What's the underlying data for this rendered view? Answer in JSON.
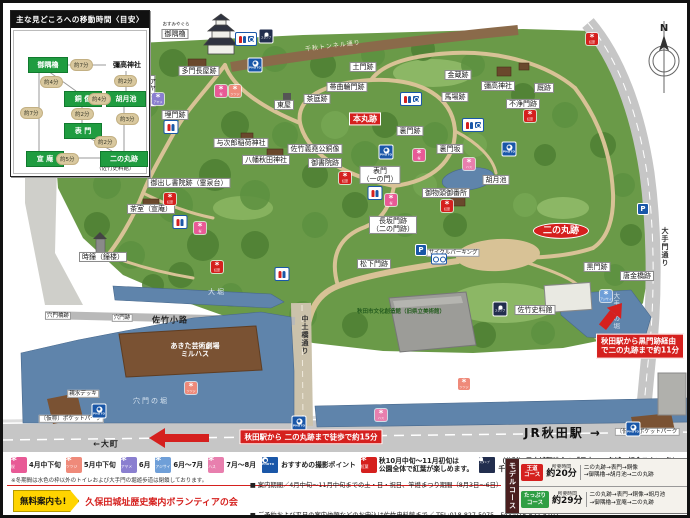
{
  "travel_time_box": {
    "title": "主な見どころへの移動時間〈目安〉",
    "nodes": [
      {
        "id": "osumiyagura",
        "label": "御隅櫓",
        "type": "green",
        "x": 14,
        "y": 26,
        "w": 38,
        "h": 14
      },
      {
        "id": "iyataka-jinja",
        "label": "彌高神社",
        "type": "text",
        "x": 92,
        "y": 28,
        "w": 42,
        "h": 12
      },
      {
        "id": "douzou",
        "label": "銅 像",
        "type": "green",
        "x": 50,
        "y": 60,
        "w": 36,
        "h": 14
      },
      {
        "id": "kogetsu-ike",
        "label": "胡月池",
        "type": "green",
        "x": 92,
        "y": 60,
        "w": 38,
        "h": 14
      },
      {
        "id": "omotemon",
        "label": "表 門",
        "type": "green",
        "x": 50,
        "y": 92,
        "w": 36,
        "h": 14
      },
      {
        "id": "sen-an",
        "label": "宣 庵",
        "type": "green",
        "x": 12,
        "y": 120,
        "w": 36,
        "h": 14
      },
      {
        "id": "ninomaru-ato",
        "label": "二の丸跡",
        "type": "green",
        "x": 86,
        "y": 120,
        "w": 46,
        "h": 14
      }
    ],
    "times": [
      {
        "label": "約7分",
        "x": 56,
        "y": 28
      },
      {
        "label": "約4分",
        "x": 26,
        "y": 45
      },
      {
        "label": "約2分",
        "x": 100,
        "y": 44
      },
      {
        "label": "約4分",
        "x": 74,
        "y": 62
      },
      {
        "label": "約2分",
        "x": 57,
        "y": 77
      },
      {
        "label": "約3分",
        "x": 102,
        "y": 82
      },
      {
        "label": "約7分",
        "x": 6,
        "y": 76
      },
      {
        "label": "約2分",
        "x": 80,
        "y": 105
      },
      {
        "label": "約5分",
        "x": 42,
        "y": 122
      }
    ],
    "note": "（佐竹史料館）"
  },
  "compass": {
    "label": "N"
  },
  "flower_defs": {
    "sakura": {
      "color": "#e85a96",
      "caption": "桜"
    },
    "tsutsuji": {
      "color": "#ef8a7a",
      "caption": "ツツジ"
    },
    "ayame": {
      "color": "#8a7fd0",
      "caption": "アヤメ"
    },
    "ajisai": {
      "color": "#6f9fd8",
      "caption": "アジサイ"
    },
    "hasu": {
      "color": "#e87fae",
      "caption": "ハス"
    },
    "momiji": {
      "color": "#d5201e",
      "caption": "紅葉"
    }
  },
  "map": {
    "labels": [
      {
        "text": "おすみやぐら",
        "x": 173,
        "y": 22,
        "type": "furi"
      },
      {
        "text": "御隅櫓",
        "x": 172,
        "y": 31,
        "type": "place"
      },
      {
        "text": "多門長屋跡",
        "x": 196,
        "y": 68,
        "type": "place"
      },
      {
        "text": "アヤメ園",
        "x": 148,
        "y": 88,
        "type": "place-v"
      },
      {
        "text": "埋門跡",
        "x": 172,
        "y": 112,
        "type": "place"
      },
      {
        "text": "土門跡",
        "x": 360,
        "y": 64,
        "type": "place"
      },
      {
        "text": "帯曲輪門跡",
        "x": 344,
        "y": 84,
        "type": "place"
      },
      {
        "text": "金蔵跡",
        "x": 455,
        "y": 72,
        "type": "place"
      },
      {
        "text": "彌高神社",
        "x": 495,
        "y": 83,
        "type": "place"
      },
      {
        "text": "馬場跡",
        "x": 452,
        "y": 94,
        "type": "place"
      },
      {
        "text": "厩跡",
        "x": 541,
        "y": 85,
        "type": "place"
      },
      {
        "text": "不浄門跡",
        "x": 520,
        "y": 101,
        "type": "place"
      },
      {
        "text": "東屋",
        "x": 281,
        "y": 102,
        "type": "place"
      },
      {
        "text": "茶庭跡",
        "x": 314,
        "y": 96,
        "type": "place"
      },
      {
        "text": "本丸跡",
        "x": 362,
        "y": 116,
        "type": "red"
      },
      {
        "text": "佐竹義堯公銅像",
        "x": 312,
        "y": 146,
        "type": "place"
      },
      {
        "text": "御書院跡",
        "x": 322,
        "y": 160,
        "type": "place"
      },
      {
        "text": "表門\n（一の門）",
        "x": 377,
        "y": 172,
        "type": "place"
      },
      {
        "text": "裏門跡",
        "x": 407,
        "y": 128,
        "type": "place"
      },
      {
        "text": "裏門坂",
        "x": 447,
        "y": 146,
        "type": "place"
      },
      {
        "text": "胡月池",
        "x": 493,
        "y": 177,
        "type": "place"
      },
      {
        "text": "御物頭御番所",
        "x": 443,
        "y": 190,
        "type": "place"
      },
      {
        "text": "御出し書院跡（霊泉台）",
        "x": 186,
        "y": 180,
        "type": "place"
      },
      {
        "text": "八幡秋田神社",
        "x": 263,
        "y": 157,
        "type": "place"
      },
      {
        "text": "与次郎稲荷神社",
        "x": 238,
        "y": 140,
        "type": "place"
      },
      {
        "text": "茶室（宣庵）",
        "x": 148,
        "y": 206,
        "type": "place"
      },
      {
        "text": "時鐘（鐘楼）",
        "x": 100,
        "y": 254,
        "type": "place"
      },
      {
        "text": "長坂門跡\n（二の門跡）",
        "x": 390,
        "y": 222,
        "type": "place"
      },
      {
        "text": "松下門跡",
        "x": 371,
        "y": 261,
        "type": "place"
      },
      {
        "text": "サイクルパーキング",
        "x": 450,
        "y": 250,
        "type": "place-s"
      },
      {
        "text": "二の丸跡",
        "x": 558,
        "y": 228,
        "type": "red-oval"
      },
      {
        "text": "黒門跡",
        "x": 594,
        "y": 264,
        "type": "place"
      },
      {
        "text": "唐金橋跡",
        "x": 634,
        "y": 273,
        "type": "place"
      },
      {
        "text": "佐竹史料館",
        "x": 532,
        "y": 307,
        "type": "place"
      },
      {
        "text": "大手門の堀",
        "x": 612,
        "y": 308,
        "type": "water-v"
      },
      {
        "text": "穴門の堀",
        "x": 148,
        "y": 398,
        "type": "water"
      },
      {
        "text": "大堀",
        "x": 214,
        "y": 289,
        "type": "water"
      },
      {
        "text": "穴門橋跡",
        "x": 55,
        "y": 313,
        "type": "place-s"
      },
      {
        "text": "穴門跡",
        "x": 119,
        "y": 315,
        "type": "place-s"
      },
      {
        "text": "佐竹小路",
        "x": 167,
        "y": 317,
        "type": "street"
      },
      {
        "text": "中土橋通り",
        "x": 302,
        "y": 332,
        "type": "street-v"
      },
      {
        "text": "広 小 路",
        "x": 296,
        "y": 433,
        "type": "street-sp"
      },
      {
        "text": "←大町",
        "x": 103,
        "y": 441,
        "type": "street"
      },
      {
        "text": "JR秋田駅 →",
        "x": 560,
        "y": 431,
        "type": "street-big"
      },
      {
        "text": "あきた芸術劇場\nミルハス",
        "x": 192,
        "y": 347,
        "type": "building-white"
      },
      {
        "text": "秋田市文化創造館（旧県立美術館）",
        "x": 398,
        "y": 309,
        "type": "green-text"
      },
      {
        "text": "親水デッキ",
        "x": 80,
        "y": 391,
        "type": "place-s"
      },
      {
        "text": "〔仮称〕ポケットパーク",
        "x": 68,
        "y": 416,
        "type": "place-s"
      },
      {
        "text": "〔仮称〕ポケットパーク",
        "x": 644,
        "y": 429,
        "type": "place-s"
      },
      {
        "text": "千秋トンネル通り",
        "x": 330,
        "y": 44,
        "type": "band-white",
        "rot": -7
      },
      {
        "text": "大手門通り",
        "x": 662,
        "y": 244,
        "type": "street-v"
      }
    ],
    "icons": [
      {
        "type": "photo",
        "x": 252,
        "y": 62
      },
      {
        "type": "photo",
        "x": 383,
        "y": 149
      },
      {
        "type": "photo",
        "x": 506,
        "y": 146
      },
      {
        "type": "photo",
        "x": 96,
        "y": 408
      },
      {
        "type": "photo",
        "x": 296,
        "y": 420
      },
      {
        "type": "photo",
        "x": 630,
        "y": 426
      },
      {
        "type": "stamp",
        "x": 263,
        "y": 33
      },
      {
        "type": "stamp",
        "x": 497,
        "y": 306
      },
      {
        "type": "toilet_acc",
        "x": 243,
        "y": 36
      },
      {
        "type": "toilet_acc",
        "x": 408,
        "y": 96
      },
      {
        "type": "toilet_acc",
        "x": 470,
        "y": 122
      },
      {
        "type": "toilet",
        "x": 168,
        "y": 124
      },
      {
        "type": "toilet",
        "x": 372,
        "y": 190
      },
      {
        "type": "toilet",
        "x": 177,
        "y": 219
      },
      {
        "type": "toilet",
        "x": 279,
        "y": 271
      },
      {
        "type": "parking",
        "x": 418,
        "y": 247
      },
      {
        "type": "parking",
        "x": 640,
        "y": 206
      },
      {
        "type": "cycle",
        "x": 436,
        "y": 256
      },
      {
        "type": "momiji",
        "x": 589,
        "y": 36
      },
      {
        "type": "momiji",
        "x": 527,
        "y": 113
      },
      {
        "type": "momiji",
        "x": 342,
        "y": 175
      },
      {
        "type": "momiji",
        "x": 167,
        "y": 196
      },
      {
        "type": "momiji",
        "x": 214,
        "y": 264
      },
      {
        "type": "momiji",
        "x": 444,
        "y": 203
      },
      {
        "type": "sakura",
        "x": 218,
        "y": 88
      },
      {
        "type": "sakura",
        "x": 416,
        "y": 152
      },
      {
        "type": "sakura",
        "x": 388,
        "y": 197
      },
      {
        "type": "sakura",
        "x": 197,
        "y": 225
      },
      {
        "type": "tsutsuji",
        "x": 232,
        "y": 88
      },
      {
        "type": "tsutsuji",
        "x": 188,
        "y": 385
      },
      {
        "type": "tsutsuji",
        "x": 461,
        "y": 381
      },
      {
        "type": "ayame",
        "x": 155,
        "y": 96
      },
      {
        "type": "ajisai",
        "x": 603,
        "y": 293
      },
      {
        "type": "hasu",
        "x": 466,
        "y": 161
      },
      {
        "type": "hasu",
        "x": 378,
        "y": 412
      }
    ],
    "route_notes": [
      {
        "text": "秋田駅から 二の丸跡まで徒歩で約15分",
        "x": 308,
        "y": 434
      },
      {
        "text": "秋田駅から黒門跡経由\nで二の丸跡まで約11分",
        "x": 637,
        "y": 343
      }
    ]
  },
  "bottom_legend": {
    "items": [
      {
        "icon": "sakura",
        "label": "4月中下旬"
      },
      {
        "icon": "tsutsuji",
        "label": "5月中下旬"
      },
      {
        "icon": "ayame",
        "label": "6月"
      },
      {
        "icon": "ajisai",
        "label": "6月～7月"
      },
      {
        "icon": "hasu",
        "label": "7月～8月"
      },
      {
        "icon": "photo",
        "label": "おすすめの撮影ポイント"
      },
      {
        "icon": "momiji",
        "label": "秋10月中旬～11月初旬は\n公園全体で紅葉が楽しめます。"
      },
      {
        "icon": "stamp",
        "label": "（公財）日本城郭協会の「日本100名城」記念スタンプは、\n千秋公園内の御隅櫓と佐竹史料館に設置しております。"
      }
    ],
    "winter_note": "※冬期間は水色の枠以外のトイレおよび大手門の堀遊歩道は閉鎖しております。"
  },
  "info_bar": {
    "free_badge": "無料案内も!",
    "org": "久保田城址歴史案内ボランティアの会",
    "line1": "■ 案内期間／4月中旬～11月中旬までの土・日・祝日、竿燈まつり期間（8月3日～6日）",
    "line2": "■ ご予約および平日の案内依頼などのお申込は佐竹史料館まで／ TEL:018-827-5075　FAX:018-827-5107"
  },
  "model_course": {
    "side_label": "モデルコース",
    "rows": [
      {
        "badge": "王道\nコース",
        "badge_color": "#d5201e",
        "time_label": "所要時間",
        "time": "約20分",
        "route": "二の丸跡→表門→銅像\n→御隅櫓→胡月池→二の丸跡"
      },
      {
        "badge": "たっぷり\nコース",
        "badge_color": "#2f9e44",
        "time_label": "所要時間",
        "time": "約29分",
        "route": "二の丸跡→表門→銅像→胡月池\n→御隅櫓→宣庵→二の丸跡"
      }
    ]
  }
}
